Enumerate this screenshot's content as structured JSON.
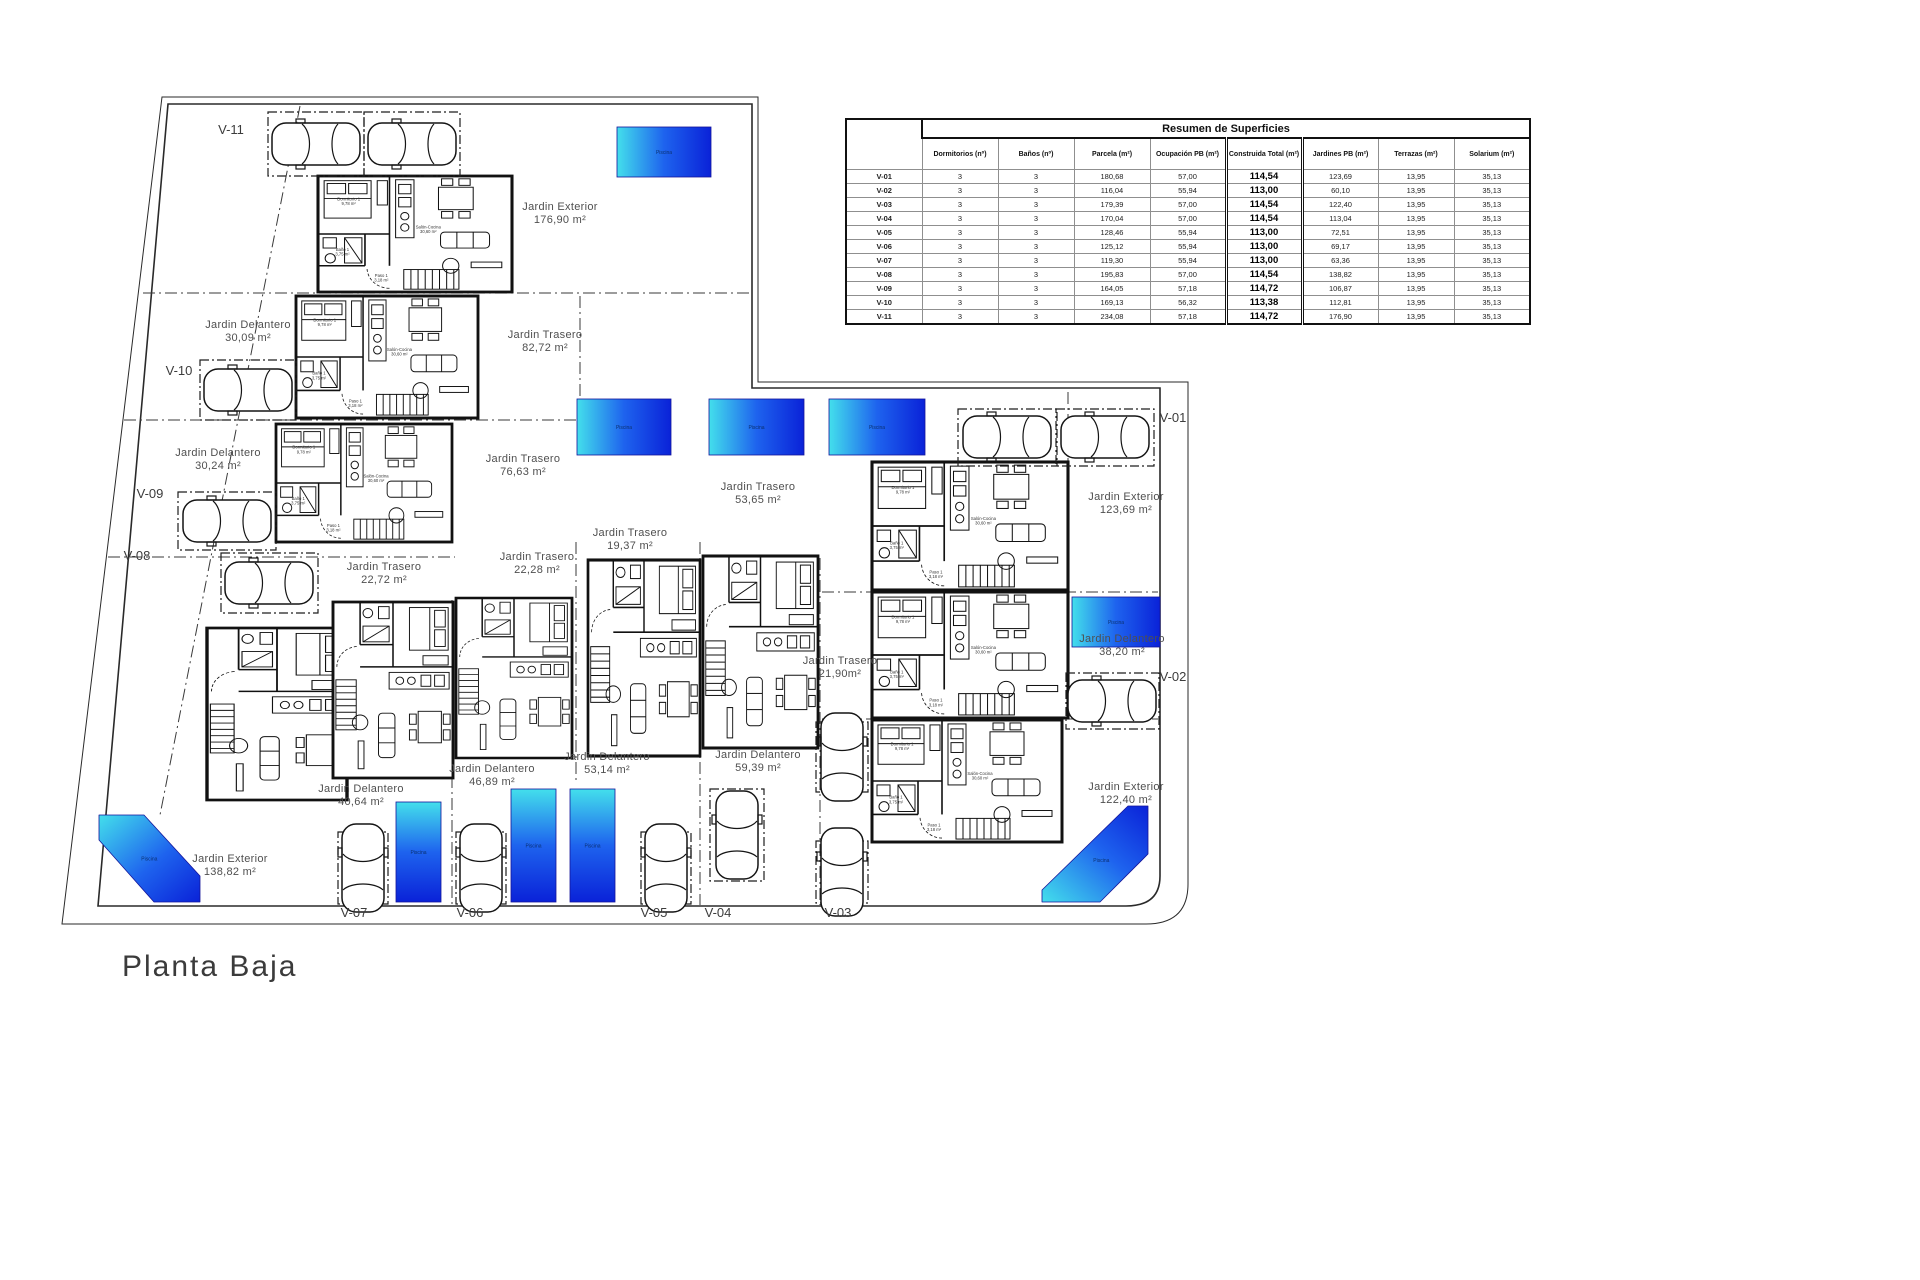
{
  "page": {
    "title": "Planta Baja"
  },
  "table": {
    "title": "Resumen de Superficies",
    "columns": [
      "Dormitorios (nº)",
      "Baños (nº)",
      "Parcela (m²)",
      "Ocupación PB (m²)",
      "Construida Total (m²)",
      "Jardines PB (m²)",
      "Terrazas (m²)",
      "Solarium (m²)"
    ],
    "rows": [
      [
        "V-01",
        "3",
        "3",
        "180,68",
        "57,00",
        "114,54",
        "123,69",
        "13,95",
        "35,13"
      ],
      [
        "V-02",
        "3",
        "3",
        "116,04",
        "55,94",
        "113,00",
        "60,10",
        "13,95",
        "35,13"
      ],
      [
        "V-03",
        "3",
        "3",
        "179,39",
        "57,00",
        "114,54",
        "122,40",
        "13,95",
        "35,13"
      ],
      [
        "V-04",
        "3",
        "3",
        "170,04",
        "57,00",
        "114,54",
        "113,04",
        "13,95",
        "35,13"
      ],
      [
        "V-05",
        "3",
        "3",
        "128,46",
        "55,94",
        "113,00",
        "72,51",
        "13,95",
        "35,13"
      ],
      [
        "V-06",
        "3",
        "3",
        "125,12",
        "55,94",
        "113,00",
        "69,17",
        "13,95",
        "35,13"
      ],
      [
        "V-07",
        "3",
        "3",
        "119,30",
        "55,94",
        "113,00",
        "63,36",
        "13,95",
        "35,13"
      ],
      [
        "V-08",
        "3",
        "3",
        "195,83",
        "57,00",
        "114,54",
        "138,82",
        "13,95",
        "35,13"
      ],
      [
        "V-09",
        "3",
        "3",
        "164,05",
        "57,18",
        "114,72",
        "106,87",
        "13,95",
        "35,13"
      ],
      [
        "V-10",
        "3",
        "3",
        "169,13",
        "56,32",
        "113,38",
        "112,81",
        "13,95",
        "35,13"
      ],
      [
        "V-11",
        "3",
        "3",
        "234,08",
        "57,18",
        "114,72",
        "176,90",
        "13,95",
        "35,13"
      ]
    ]
  },
  "plan": {
    "pool_label": "Piscina",
    "plot_labels": [
      {
        "t": "V-11",
        "x": 231,
        "y": 134
      },
      {
        "t": "V-10",
        "x": 179,
        "y": 375
      },
      {
        "t": "V-09",
        "x": 150,
        "y": 498
      },
      {
        "t": "V-08",
        "x": 137,
        "y": 560
      },
      {
        "t": "V-01",
        "x": 1173,
        "y": 422
      },
      {
        "t": "V-02",
        "x": 1173,
        "y": 681
      },
      {
        "t": "V-07",
        "x": 354,
        "y": 917
      },
      {
        "t": "V-06",
        "x": 470,
        "y": 917
      },
      {
        "t": "V-05",
        "x": 654,
        "y": 917
      },
      {
        "t": "V-04",
        "x": 718,
        "y": 917
      },
      {
        "t": "V-03",
        "x": 838,
        "y": 917
      }
    ],
    "garden_labels": [
      {
        "n": "Jardin Exterior",
        "a": "176,90 m²",
        "x": 560,
        "y": 210
      },
      {
        "n": "Jardin Delantero",
        "a": "30,09 m²",
        "x": 248,
        "y": 328
      },
      {
        "n": "Jardin Trasero",
        "a": "82,72 m²",
        "x": 545,
        "y": 338
      },
      {
        "n": "Jardin Delantero",
        "a": "30,24 m²",
        "x": 218,
        "y": 456
      },
      {
        "n": "Jardin Trasero",
        "a": "76,63 m²",
        "x": 523,
        "y": 462
      },
      {
        "n": "Jardin Trasero",
        "a": "53,65 m²",
        "x": 758,
        "y": 490
      },
      {
        "n": "Jardin Trasero",
        "a": "19,37 m²",
        "x": 630,
        "y": 536
      },
      {
        "n": "Jardin Trasero",
        "a": "22,28 m²",
        "x": 537,
        "y": 560
      },
      {
        "n": "Jardin Trasero",
        "a": "22,72 m²",
        "x": 384,
        "y": 570
      },
      {
        "n": "Jardin Exterior",
        "a": "123,69 m²",
        "x": 1126,
        "y": 500
      },
      {
        "n": "Jardin Delantero",
        "a": "38,20 m²",
        "x": 1122,
        "y": 642
      },
      {
        "n": "Jardin Trasero",
        "a": "21,90m²",
        "x": 840,
        "y": 664
      },
      {
        "n": "Jardin Delantero",
        "a": "59,39 m²",
        "x": 758,
        "y": 758
      },
      {
        "n": "Jardin Delantero",
        "a": "53,14 m²",
        "x": 607,
        "y": 760
      },
      {
        "n": "Jardin Delantero",
        "a": "46,89 m²",
        "x": 492,
        "y": 772
      },
      {
        "n": "Jardin Delantero",
        "a": "40,64 m²",
        "x": 361,
        "y": 792
      },
      {
        "n": "Jardin Exterior",
        "a": "138,82 m²",
        "x": 230,
        "y": 862
      },
      {
        "n": "Jardin Exterior",
        "a": "122,40 m²",
        "x": 1126,
        "y": 790
      }
    ],
    "room_labels": [
      {
        "t": "Dormitorio 1",
        "a": "9,78 m²",
        "dx": 30,
        "dy": 26
      },
      {
        "t": "Baño 1",
        "a": "3,75 m²",
        "dx": 24,
        "dy": 80
      },
      {
        "t": "Paso 1",
        "a": "3,18 m²",
        "dx": 62,
        "dy": 108
      },
      {
        "t": "Salón-Cocina",
        "a": "30,60 m²",
        "dx": 108,
        "dy": 56
      }
    ],
    "houses": [
      {
        "id": "V-11",
        "x": 318,
        "y": 176,
        "w": 194,
        "h": 116,
        "rot": 0
      },
      {
        "id": "V-10",
        "x": 296,
        "y": 296,
        "w": 182,
        "h": 122,
        "rot": 0
      },
      {
        "id": "V-09",
        "x": 276,
        "y": 424,
        "w": 176,
        "h": 118,
        "rot": 0
      },
      {
        "id": "V-01",
        "x": 872,
        "y": 462,
        "w": 196,
        "h": 128,
        "rot": 0
      },
      {
        "id": "V-02",
        "x": 872,
        "y": 592,
        "w": 196,
        "h": 126,
        "rot": 0
      },
      {
        "id": "V-03",
        "x": 872,
        "y": 720,
        "w": 190,
        "h": 122,
        "rot": 0
      },
      {
        "id": "V-08",
        "x": 207,
        "y": 628,
        "w": 140,
        "h": 172,
        "rot": 90
      },
      {
        "id": "V-07",
        "x": 333,
        "y": 602,
        "w": 120,
        "h": 176,
        "rot": 90
      },
      {
        "id": "V-06",
        "x": 456,
        "y": 598,
        "w": 116,
        "h": 160,
        "rot": 90
      },
      {
        "id": "V-05",
        "x": 588,
        "y": 560,
        "w": 112,
        "h": 196,
        "rot": 90
      },
      {
        "id": "V-04",
        "x": 703,
        "y": 556,
        "w": 115,
        "h": 192,
        "rot": 90
      }
    ],
    "pools": {
      "rects": [
        [
          617,
          127,
          94,
          50,
          "h"
        ],
        [
          577,
          399,
          94,
          56,
          "h"
        ],
        [
          709,
          399,
          95,
          56,
          "h"
        ],
        [
          829,
          399,
          96,
          56,
          "h"
        ],
        [
          1072,
          597,
          88,
          50,
          "h"
        ],
        [
          396,
          802,
          45,
          100,
          "v"
        ],
        [
          511,
          789,
          45,
          113,
          "v"
        ],
        [
          570,
          789,
          45,
          113,
          "v"
        ]
      ],
      "polys": [
        {
          "points": "99,815 144,815 200,876 200,902 154,902 99,840",
          "dir": "d1"
        },
        {
          "points": "1128,806 1148,806 1148,854 1100,902 1042,902 1042,890",
          "dir": "d2"
        }
      ]
    },
    "cars": [
      [
        316,
        144,
        0
      ],
      [
        412,
        144,
        0
      ],
      [
        248,
        390,
        0
      ],
      [
        227,
        521,
        0
      ],
      [
        269,
        583,
        0
      ],
      [
        1007,
        437,
        0
      ],
      [
        1105,
        437,
        0
      ],
      [
        1112,
        701,
        0
      ],
      [
        363,
        868,
        90
      ],
      [
        481,
        868,
        90
      ],
      [
        666,
        868,
        90
      ],
      [
        737,
        835,
        90
      ],
      [
        842,
        757,
        90
      ],
      [
        842,
        872,
        90
      ]
    ],
    "parking": [
      [
        268,
        112,
        96,
        64
      ],
      [
        364,
        112,
        96,
        64
      ],
      [
        200,
        360,
        96,
        60
      ],
      [
        178,
        492,
        98,
        58
      ],
      [
        221,
        553,
        97,
        60
      ],
      [
        958,
        409,
        99,
        57
      ],
      [
        1056,
        409,
        98,
        57
      ],
      [
        1066,
        673,
        93,
        56
      ],
      [
        338,
        832,
        50,
        72
      ],
      [
        456,
        832,
        50,
        72
      ],
      [
        641,
        832,
        50,
        72
      ],
      [
        710,
        789,
        54,
        92
      ],
      [
        816,
        722,
        52,
        70
      ],
      [
        816,
        841,
        52,
        62
      ]
    ],
    "dividers": [
      [
        143,
        293,
        752,
        293
      ],
      [
        124,
        420,
        578,
        420
      ],
      [
        108,
        557,
        455,
        557
      ],
      [
        452,
        600,
        452,
        905
      ],
      [
        576,
        542,
        576,
        784
      ],
      [
        700,
        542,
        700,
        905
      ],
      [
        820,
        558,
        820,
        905
      ],
      [
        822,
        592,
        1158,
        592
      ],
      [
        822,
        719,
        1158,
        719
      ],
      [
        300,
        106,
        160,
        815
      ],
      [
        580,
        296,
        580,
        418
      ],
      [
        1068,
        392,
        1068,
        588
      ]
    ],
    "colors": {
      "pool_start": "#43dfec",
      "pool_mid": "#1e63ee",
      "pool_end": "#0a22d8",
      "wall": "#111111",
      "label": "#4f4f4f",
      "boundary": "#2a2a2a"
    }
  }
}
